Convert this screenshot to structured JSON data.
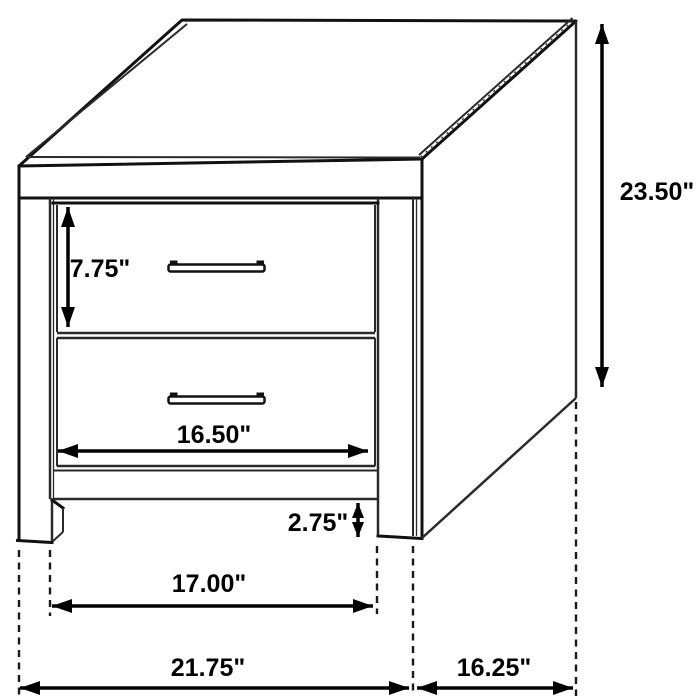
{
  "diagram": {
    "type": "furniture-dimension-drawing",
    "subject": "two-drawer nightstand, isometric line drawing with dimension callouts",
    "background_color": "#ffffff",
    "line_color": "#111111",
    "dimension_color": "#000000",
    "units": "inches",
    "dimensions": [
      {
        "name": "overall_height",
        "label": "23.50\"",
        "orientation": "vertical"
      },
      {
        "name": "top_drawer_height",
        "label": "7.75\"",
        "orientation": "vertical"
      },
      {
        "name": "drawer_width",
        "label": "16.50\"",
        "orientation": "horizontal"
      },
      {
        "name": "base_clearance",
        "label": "2.75\"",
        "orientation": "vertical"
      },
      {
        "name": "leg_inner_width",
        "label": "17.00\"",
        "orientation": "horizontal"
      },
      {
        "name": "overall_width",
        "label": "21.75\"",
        "orientation": "horizontal"
      },
      {
        "name": "overall_depth",
        "label": "16.25\"",
        "orientation": "horizontal"
      }
    ],
    "features": {
      "drawer_count": 2,
      "handle_style": "bar pull",
      "extension_line_style": "dashed",
      "arrow_style": "double-headed filled triangles"
    }
  }
}
